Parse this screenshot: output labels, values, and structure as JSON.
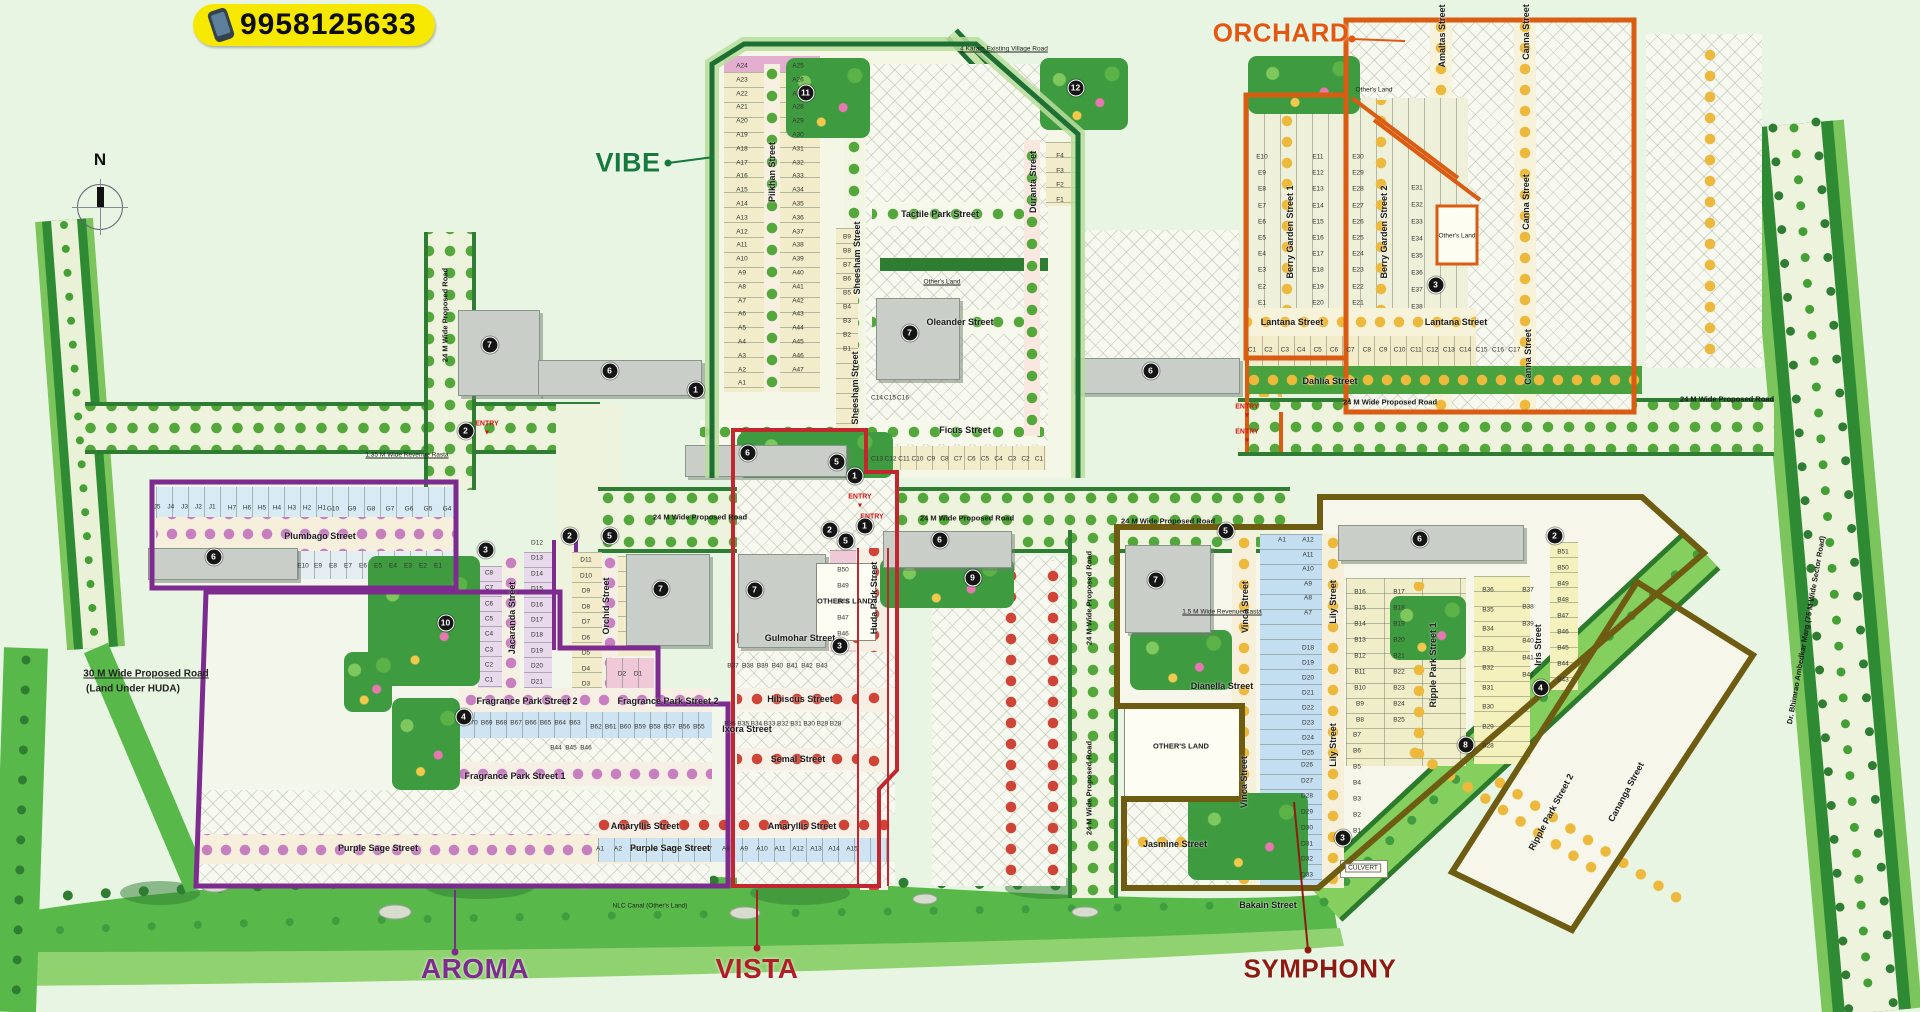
{
  "badge": {
    "phone": "9958125633"
  },
  "compass": {
    "north_label": "N"
  },
  "entry_label": "ENTRY",
  "colors": {
    "badge_bg": "#f6e800",
    "road_edge": "#2f7d33",
    "greenbelt": "#58b84a",
    "canal": "#85cf5f"
  },
  "sections": [
    {
      "id": "vibe",
      "label": "VIBE",
      "color": "#157a3c",
      "line": "#1d6f34",
      "x": 628,
      "y": 163,
      "fs": 27,
      "leader": [
        668,
        163,
        714,
        157
      ]
    },
    {
      "id": "orchard",
      "label": "ORCHARD",
      "color": "#e4570e",
      "line": "#d95c12",
      "x": 1281,
      "y": 33,
      "fs": 26,
      "leader": [
        1352,
        39,
        1405,
        41
      ]
    },
    {
      "id": "aroma",
      "label": "AROMA",
      "color": "#7d2b8e",
      "line": "#7d2b8e",
      "x": 475,
      "y": 969,
      "fs": 28,
      "leader": [
        455,
        952,
        455,
        890
      ]
    },
    {
      "id": "vista",
      "label": "VISTA",
      "color": "#b01e28",
      "line": "#c2262e",
      "x": 757,
      "y": 969,
      "fs": 28,
      "leader": [
        757,
        948,
        757,
        890
      ]
    },
    {
      "id": "symphony",
      "label": "SYMPHONY",
      "color": "#8e1b12",
      "line": "#6d5c12",
      "x": 1320,
      "y": 969,
      "fs": 26,
      "leader": [
        1308,
        950,
        1294,
        802
      ]
    }
  ],
  "streets": [
    {
      "t": "Plumbago Street",
      "x": 320,
      "y": 536
    },
    {
      "t": "Fragrance Park Street 2",
      "x": 527,
      "y": 701
    },
    {
      "t": "Fragrance Park Street 2",
      "x": 668,
      "y": 701
    },
    {
      "t": "Fragrance Park Street 1",
      "x": 515,
      "y": 776
    },
    {
      "t": "Purple Sage Street",
      "x": 378,
      "y": 848
    },
    {
      "t": "Purple Sage Street",
      "x": 670,
      "y": 848
    },
    {
      "t": "Hibiscus Street",
      "x": 800,
      "y": 699
    },
    {
      "t": "Semal Street",
      "x": 798,
      "y": 759
    },
    {
      "t": "Amaryllis Street",
      "x": 645,
      "y": 826
    },
    {
      "t": "Amaryllis Street",
      "x": 802,
      "y": 826
    },
    {
      "t": "Ixora Street",
      "x": 747,
      "y": 729
    },
    {
      "t": "Gulmohar Street",
      "x": 800,
      "y": 638
    },
    {
      "t": "Ficus Street",
      "x": 965,
      "y": 430
    },
    {
      "t": "Tactile Park Street",
      "x": 940,
      "y": 214
    },
    {
      "t": "Oleander Street",
      "x": 960,
      "y": 322
    },
    {
      "t": "Lantana Street",
      "x": 1292,
      "y": 322
    },
    {
      "t": "Lantana Street",
      "x": 1456,
      "y": 322
    },
    {
      "t": "Dahlia Street",
      "x": 1330,
      "y": 381
    },
    {
      "t": "Jasmine Street",
      "x": 1175,
      "y": 844
    },
    {
      "t": "Dianella Street",
      "x": 1222,
      "y": 686
    },
    {
      "t": "Bakain Street",
      "x": 1268,
      "y": 905
    },
    {
      "t": "Pilkhan Street",
      "x": 772,
      "y": 172,
      "r": -90
    },
    {
      "t": "Sheesham Street",
      "x": 857,
      "y": 258,
      "r": -90
    },
    {
      "t": "Sheesham Street",
      "x": 855,
      "y": 388,
      "r": -90
    },
    {
      "t": "Duranta Street",
      "x": 1033,
      "y": 182,
      "r": -90
    },
    {
      "t": "Jacaranda Street",
      "x": 512,
      "y": 618,
      "r": -90
    },
    {
      "t": "Orchid Street",
      "x": 606,
      "y": 606,
      "r": -90
    },
    {
      "t": "Huda Park Street",
      "x": 874,
      "y": 598,
      "r": -90
    },
    {
      "t": "Berry Garden Street 1",
      "x": 1290,
      "y": 232,
      "r": -90
    },
    {
      "t": "Berry Garden Street 2",
      "x": 1384,
      "y": 232,
      "r": -90
    },
    {
      "t": "Amaltas Street",
      "x": 1442,
      "y": 36,
      "r": -90
    },
    {
      "t": "Canna Street",
      "x": 1526,
      "y": 32,
      "r": -90
    },
    {
      "t": "Canna Street",
      "x": 1526,
      "y": 202,
      "r": -90
    },
    {
      "t": "Canna Street",
      "x": 1528,
      "y": 357,
      "r": -90
    },
    {
      "t": "Vinca Street",
      "x": 1245,
      "y": 607,
      "r": -90
    },
    {
      "t": "Vinca Street",
      "x": 1244,
      "y": 782,
      "r": -90
    },
    {
      "t": "Lily Street",
      "x": 1333,
      "y": 602,
      "r": -90
    },
    {
      "t": "Lily Street",
      "x": 1333,
      "y": 745,
      "r": -90
    },
    {
      "t": "Ripple Park Street 1",
      "x": 1433,
      "y": 665,
      "r": -90
    },
    {
      "t": "Iris Street",
      "x": 1538,
      "y": 645,
      "r": -90
    },
    {
      "t": "Ripple Park Street 2",
      "x": 1551,
      "y": 812,
      "r": -62
    },
    {
      "t": "Cananga Street",
      "x": 1626,
      "y": 792,
      "r": -62
    }
  ],
  "road_labels": [
    {
      "t": "24 M Wide Proposed Road",
      "x": 700,
      "y": 517
    },
    {
      "t": "24 M Wide Proposed Road",
      "x": 967,
      "y": 518
    },
    {
      "t": "24 M Wide Proposed Road",
      "x": 1168,
      "y": 521
    },
    {
      "t": "24 M Wide Proposed Road",
      "x": 1390,
      "y": 402
    },
    {
      "t": "24 M Wide Proposed Road",
      "x": 1727,
      "y": 399
    },
    {
      "t": "24 M Wide Proposed Road",
      "x": 445,
      "y": 315,
      "r": -90
    },
    {
      "t": "24 M Wide Proposed Road",
      "x": 1089,
      "y": 598,
      "r": -90
    },
    {
      "t": "24 M Wide Proposed Road",
      "x": 1089,
      "y": 788,
      "r": -90
    },
    {
      "t": "Dr. Bhimrao Ambedkar Marg (75 M Wide Sector Road)",
      "x": 1806,
      "y": 630,
      "r": -80
    }
  ],
  "notes": [
    {
      "t": "4 Karam Existing Village Road",
      "x": 1004,
      "y": 49,
      "u": 1
    },
    {
      "t": "1.35 M Wide Revenue Rasta",
      "x": 407,
      "y": 455,
      "u": 1
    },
    {
      "t": "1.5 M Wide Revenue Rasta",
      "x": 1222,
      "y": 612,
      "u": 1
    },
    {
      "t": "30 M Wide Proposed Road",
      "x": 146,
      "y": 674,
      "u": 1,
      "b": 1
    },
    {
      "t": "(Land Under HUDA)",
      "x": 133,
      "y": 689,
      "b": 1
    },
    {
      "t": "NLC Canal (Other's Land)",
      "x": 650,
      "y": 906
    },
    {
      "t": "Other's Land",
      "x": 1374,
      "y": 90
    },
    {
      "t": "Other's Land",
      "x": 1457,
      "y": 236
    },
    {
      "t": "Other's Land",
      "x": 942,
      "y": 282,
      "u": 1
    },
    {
      "t": "CULVERT",
      "x": 1363,
      "y": 868,
      "box": 1
    },
    {
      "t": "OTHER'S LAND",
      "x": 845,
      "y": 601,
      "big": 1
    },
    {
      "t": "OTHER'S LAND",
      "x": 1181,
      "y": 746,
      "big": 1
    }
  ],
  "entries": [
    {
      "x": 487,
      "y": 424
    },
    {
      "x": 860,
      "y": 497
    },
    {
      "x": 872,
      "y": 517
    },
    {
      "x": 1247,
      "y": 407
    },
    {
      "x": 1247,
      "y": 432
    }
  ],
  "amenities": [
    {
      "n": "1",
      "x": 703,
      "y": 397
    },
    {
      "n": "1",
      "x": 862,
      "y": 483
    },
    {
      "n": "1",
      "x": 872,
      "y": 533
    },
    {
      "n": "2",
      "x": 473,
      "y": 438
    },
    {
      "n": "2",
      "x": 577,
      "y": 543
    },
    {
      "n": "2",
      "x": 837,
      "y": 537
    },
    {
      "n": "2",
      "x": 1562,
      "y": 543
    },
    {
      "n": "3",
      "x": 493,
      "y": 557
    },
    {
      "n": "3",
      "x": 847,
      "y": 653
    },
    {
      "n": "3",
      "x": 1443,
      "y": 292
    },
    {
      "n": "3",
      "x": 1350,
      "y": 845
    },
    {
      "n": "4",
      "x": 471,
      "y": 724
    },
    {
      "n": "4",
      "x": 1548,
      "y": 695
    },
    {
      "n": "5",
      "x": 617,
      "y": 543
    },
    {
      "n": "5",
      "x": 844,
      "y": 469
    },
    {
      "n": "5",
      "x": 853,
      "y": 548
    },
    {
      "n": "5",
      "x": 1233,
      "y": 538
    },
    {
      "n": "6",
      "x": 221,
      "y": 564
    },
    {
      "n": "6",
      "x": 617,
      "y": 378
    },
    {
      "n": "6",
      "x": 755,
      "y": 460
    },
    {
      "n": "6",
      "x": 947,
      "y": 547
    },
    {
      "n": "6",
      "x": 1158,
      "y": 378
    },
    {
      "n": "6",
      "x": 1427,
      "y": 546
    },
    {
      "n": "7",
      "x": 497,
      "y": 352
    },
    {
      "n": "7",
      "x": 917,
      "y": 340
    },
    {
      "n": "7",
      "x": 668,
      "y": 596
    },
    {
      "n": "7",
      "x": 762,
      "y": 597
    },
    {
      "n": "7",
      "x": 1163,
      "y": 587
    },
    {
      "n": "8",
      "x": 1473,
      "y": 752
    },
    {
      "n": "9",
      "x": 980,
      "y": 585
    },
    {
      "n": "10",
      "x": 453,
      "y": 630
    },
    {
      "n": "11",
      "x": 813,
      "y": 100
    },
    {
      "n": "12",
      "x": 1083,
      "y": 95
    }
  ],
  "plot_groups": [
    {
      "ids": [
        "J5",
        "J4",
        "J3",
        "J2",
        "J1"
      ],
      "x": 157,
      "y": 507,
      "dx": 13.8
    },
    {
      "ids": [
        "H7",
        "H6",
        "H5",
        "H4",
        "H3",
        "H2",
        "H1"
      ],
      "x": 232,
      "y": 508,
      "dx": 15
    },
    {
      "ids": [
        "G10",
        "G9",
        "G8",
        "G7",
        "G6",
        "G5",
        "G4"
      ],
      "x": 333,
      "y": 509,
      "dx": 19
    },
    {
      "ids": [
        "E10",
        "E9",
        "E8",
        "E7",
        "E6",
        "E5",
        "E4",
        "E3",
        "E2",
        "E1"
      ],
      "x": 303,
      "y": 566,
      "dx": 15
    },
    {
      "ids": [
        "C8",
        "C7",
        "C6",
        "C5",
        "C4",
        "C3",
        "C2",
        "C1"
      ],
      "x": 489,
      "y": 573,
      "dy": 15.3
    },
    {
      "ids": [
        "D12",
        "D13",
        "D14",
        "D15",
        "D16",
        "D17",
        "D18",
        "D19",
        "D20",
        "D21"
      ],
      "x": 537,
      "y": 543,
      "dy": 15.4
    },
    {
      "ids": [
        "D11",
        "D10",
        "D9",
        "D8",
        "D7",
        "D6",
        "D5",
        "D4",
        "D3"
      ],
      "x": 586,
      "y": 560,
      "dy": 15.5
    },
    {
      "ids": [
        "D2",
        "D1"
      ],
      "x": 622,
      "y": 674,
      "dx": 16
    },
    {
      "ids": [
        "B70",
        "B69",
        "B68",
        "B67",
        "B66",
        "B65",
        "B64",
        "B63"
      ],
      "x": 472,
      "y": 723,
      "dx": 14.7
    },
    {
      "ids": [
        "B62",
        "B61",
        "B60",
        "B59",
        "B58",
        "B57",
        "B56",
        "B55"
      ],
      "x": 596,
      "y": 727,
      "dx": 14.7
    },
    {
      "ids": [
        "B44",
        "B45",
        "B46"
      ],
      "x": 556,
      "y": 748,
      "dx": 15
    },
    {
      "ids": [
        "A1",
        "A2",
        "A3",
        "A4",
        "A5",
        "A6",
        "A7",
        "A8",
        "A9",
        "A10",
        "A11",
        "A12",
        "A13",
        "A14",
        "A15"
      ],
      "x": 600,
      "y": 849,
      "dx": 18
    },
    {
      "ids": [
        "B36",
        "B35",
        "B34",
        "B33",
        "B32",
        "B31",
        "B30",
        "B29",
        "B28"
      ],
      "x": 730,
      "y": 724,
      "dx": 13.2
    },
    {
      "ids": [
        "B37",
        "B38",
        "B39",
        "B40",
        "B41",
        "B42",
        "B43"
      ],
      "x": 733,
      "y": 666,
      "dx": 14.8
    },
    {
      "ids": [
        "B50",
        "B49",
        "B48",
        "B47",
        "B46"
      ],
      "x": 843,
      "y": 570,
      "dy": 16
    },
    {
      "ids": [
        "A24",
        "A23",
        "A22",
        "A21",
        "A20",
        "A19",
        "A18",
        "A17",
        "A16",
        "A15",
        "A14",
        "A13",
        "A12",
        "A11",
        "A10",
        "A9",
        "A8",
        "A7",
        "A6",
        "A5",
        "A4",
        "A3",
        "A2",
        "A1"
      ],
      "x": 742,
      "y": 66,
      "dy": 13.8
    },
    {
      "ids": [
        "A25",
        "A26",
        "A27",
        "A28",
        "A29",
        "A30",
        "A31",
        "A32",
        "A33",
        "A34",
        "A35",
        "A36",
        "A37",
        "A38",
        "A39",
        "A40",
        "A41",
        "A42",
        "A43",
        "A44",
        "A45",
        "A46",
        "A47"
      ],
      "x": 798,
      "y": 66,
      "dy": 13.8
    },
    {
      "ids": [
        "B9",
        "B8",
        "B7",
        "B6",
        "B5",
        "B4",
        "B3",
        "B2",
        "B1"
      ],
      "x": 847,
      "y": 237,
      "dy": 14
    },
    {
      "ids": [
        "C13",
        "C12",
        "C11",
        "C10",
        "C9",
        "C8",
        "C7",
        "C6",
        "C5",
        "C4",
        "C3",
        "C2",
        "C1"
      ],
      "x": 877,
      "y": 459,
      "dx": 13.5
    },
    {
      "ids": [
        "C14",
        "C15",
        "C16"
      ],
      "x": 877,
      "y": 398,
      "dx": 13
    },
    {
      "ids": [
        "F4",
        "F3",
        "F2",
        "F1"
      ],
      "x": 1060,
      "y": 156,
      "dy": 14.7
    },
    {
      "ids": [
        "E10",
        "E9",
        "E8",
        "E7",
        "E6",
        "E5",
        "E4",
        "E3",
        "E2",
        "E1"
      ],
      "x": 1262,
      "y": 157,
      "dy": 16.2
    },
    {
      "ids": [
        "E11",
        "E12",
        "E13",
        "E14",
        "E15",
        "E16",
        "E17",
        "E18",
        "E19",
        "E20"
      ],
      "x": 1318,
      "y": 157,
      "dy": 16.2
    },
    {
      "ids": [
        "E30",
        "E29",
        "E28",
        "E27",
        "E26",
        "E25",
        "E24",
        "E23",
        "E22",
        "E21"
      ],
      "x": 1358,
      "y": 157,
      "dy": 16.2
    },
    {
      "ids": [
        "E31",
        "E32",
        "E33",
        "E34",
        "E35",
        "E36",
        "E37",
        "E38"
      ],
      "x": 1417,
      "y": 188,
      "dy": 17
    },
    {
      "ids": [
        "C1",
        "C2",
        "C3",
        "C4",
        "C5",
        "C6",
        "C7",
        "C8",
        "C9",
        "C10",
        "C11",
        "C12",
        "C13",
        "C14",
        "C15",
        "C16",
        "C17"
      ],
      "x": 1252,
      "y": 350,
      "dx": 16.4
    },
    {
      "ids": [
        "A1"
      ],
      "x": 1282,
      "y": 540
    },
    {
      "ids": [
        "A12",
        "A11",
        "A10",
        "A9",
        "A8",
        "A7"
      ],
      "x": 1308,
      "y": 540,
      "dy": 14.5
    },
    {
      "ids": [
        "D18",
        "D19",
        "D20",
        "D21",
        "D22",
        "D23",
        "D24",
        "D25"
      ],
      "x": 1308,
      "y": 648,
      "dy": 15
    },
    {
      "ids": [
        "D26",
        "D27",
        "D28",
        "D29",
        "D30",
        "D31",
        "D32",
        "D33"
      ],
      "x": 1307,
      "y": 765,
      "dy": 15.7
    },
    {
      "ids": [
        "B16",
        "B15",
        "B14",
        "B13",
        "B12",
        "B11",
        "B10",
        "B9",
        "B8"
      ],
      "x": 1360,
      "y": 592,
      "dy": 16
    },
    {
      "ids": [
        "B17",
        "B18",
        "B19",
        "B20",
        "B21",
        "B22",
        "B23",
        "B24",
        "B25"
      ],
      "x": 1399,
      "y": 592,
      "dy": 16
    },
    {
      "ids": [
        "B7",
        "B6",
        "B5",
        "B4",
        "B3",
        "B2",
        "B1"
      ],
      "x": 1357,
      "y": 735,
      "dy": 16
    },
    {
      "ids": [
        "B36",
        "B35",
        "B34",
        "B33",
        "B32",
        "B31",
        "B30",
        "B29",
        "B28"
      ],
      "x": 1488,
      "y": 590,
      "dy": 19.5
    },
    {
      "ids": [
        "B37",
        "B38",
        "B39",
        "B40",
        "B41",
        "B42"
      ],
      "x": 1528,
      "y": 590,
      "dy": 17
    },
    {
      "ids": [
        "B51",
        "B50",
        "B49",
        "B48",
        "B47",
        "B46",
        "B45",
        "B44",
        "B43"
      ],
      "x": 1563,
      "y": 552,
      "dy": 16
    }
  ]
}
